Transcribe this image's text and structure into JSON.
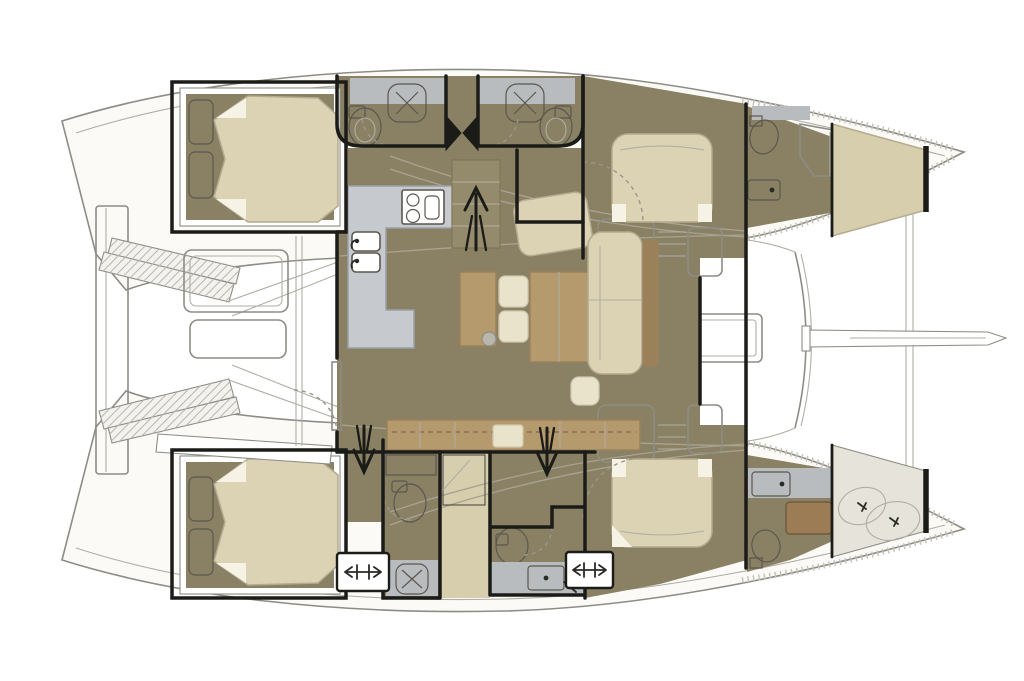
{
  "diagram": {
    "kind": "catamaran-yacht-floor-plan",
    "view": "overhead-deck-plan",
    "orientation": "bow-right-stern-left",
    "hull_count": 2,
    "double_cabins": 4,
    "small_berth_spaces": 2,
    "bathrooms": 4,
    "bow_head_compartments": 2,
    "companionway_arrows": {
      "up": 1,
      "down": 2
    },
    "deck_hatches": 2,
    "cockpit_tables": 1,
    "galley_burners": 2,
    "galley_sink_bowls": 2
  },
  "colors": {
    "bg": "#ffffff",
    "hull_fill": "#fbfaf6",
    "hull_line": "#8d8d85",
    "wall": "#1b1b18",
    "floor": "#8a8164",
    "counter_galley": "#c6c9cd",
    "counter_bath": "#b9bcbf",
    "mattress": "#dcd3b4",
    "mattress_edge": "#b4ab90",
    "cushion": "#e9e3cb",
    "wood": "#b59a6e",
    "wood_dark": "#9b815a",
    "bow_bunk": "#d7ceae",
    "locker": "#e6e4da",
    "tray": "#9c7c54",
    "fixture": "#ffffff",
    "stair": "#948b6c",
    "steps": "#f3f2ee",
    "white": "#ffffff"
  }
}
